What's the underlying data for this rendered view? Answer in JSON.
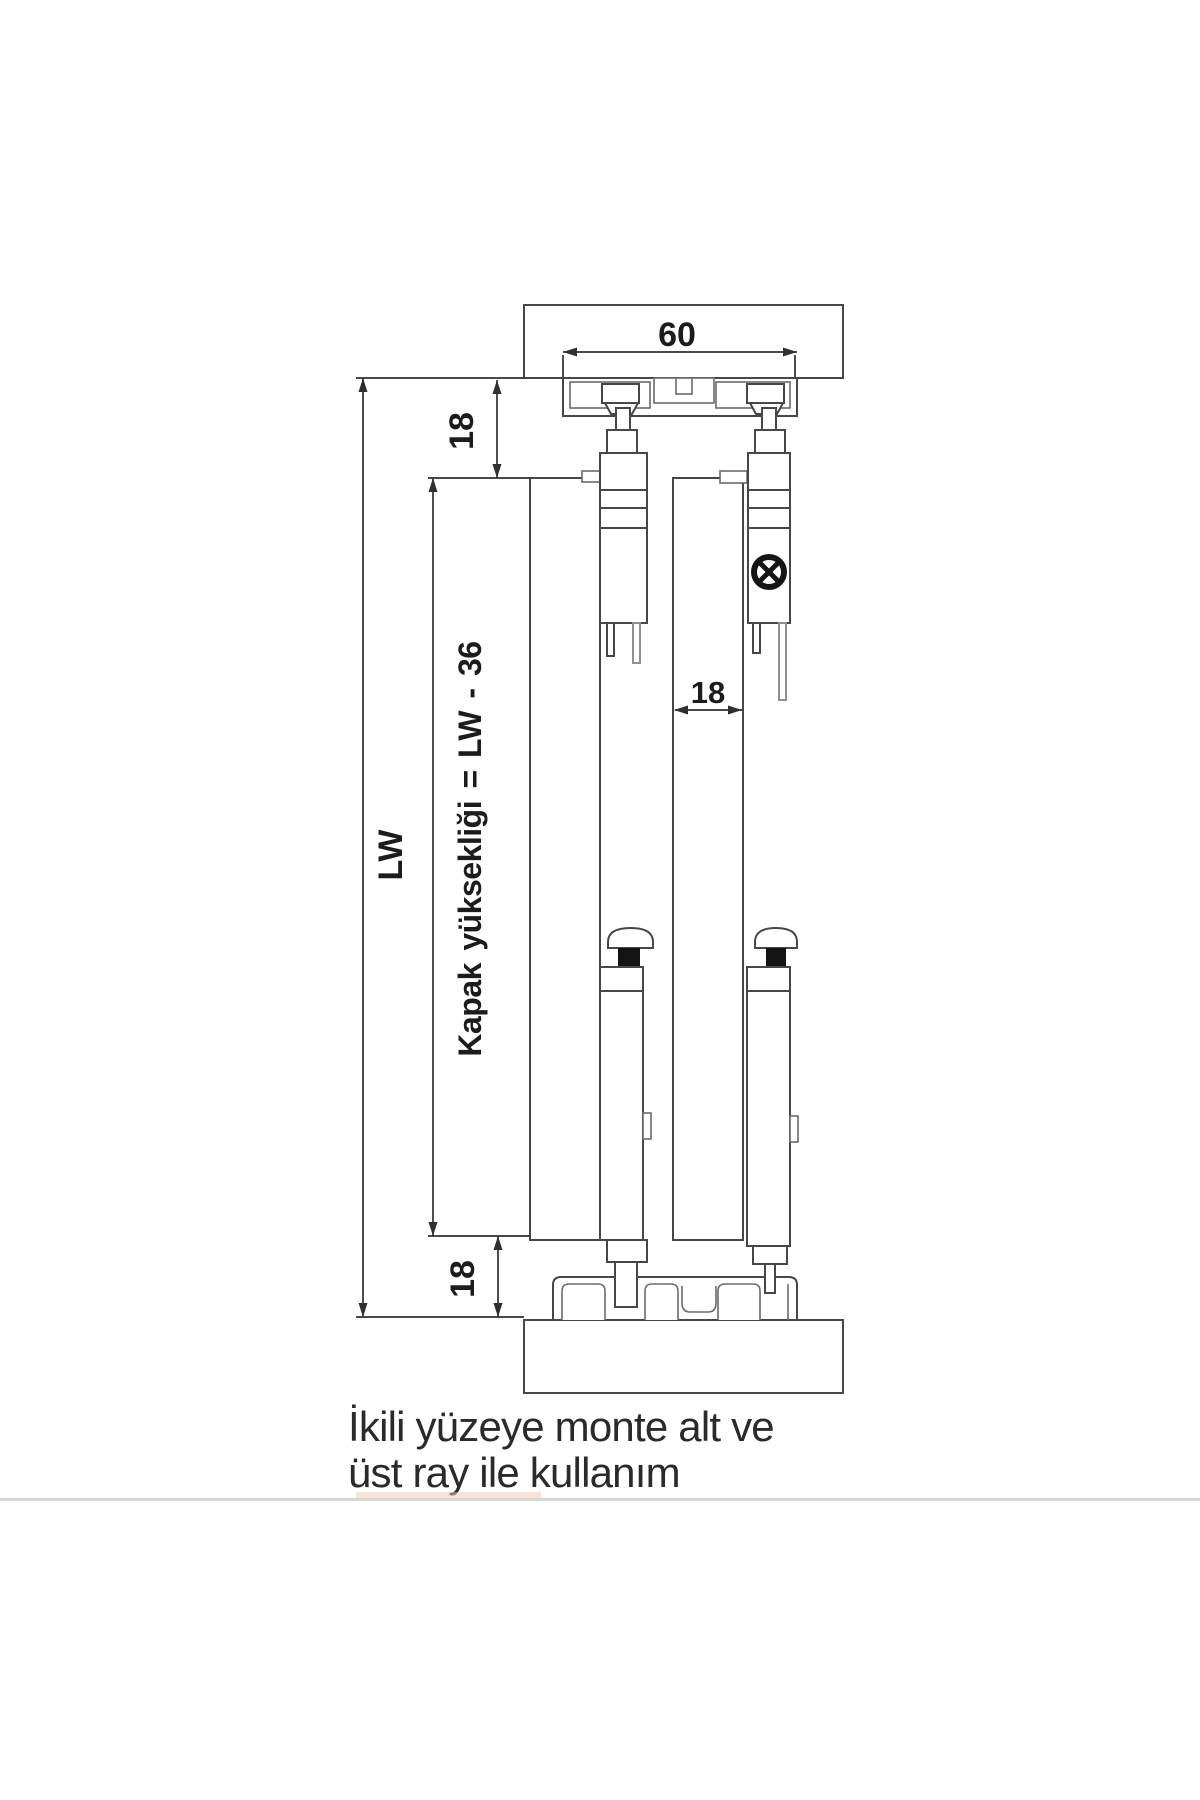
{
  "diagram": {
    "dims": {
      "rail_width": "60",
      "top_clearance": "18",
      "opening_height": "LW",
      "door_height_formula": "Kapak yüksekliği = LW - 36",
      "door_thickness": "18",
      "bottom_clearance": "18"
    },
    "caption_line1": "İkili yüzeye monte alt ve",
    "caption_line2": "üst ray ile kullanım",
    "colors": {
      "line": "#474747",
      "dimension": "#2f2f2f",
      "text": "#1c1c1c",
      "separator": "#d6d6d6",
      "highlight": "#f2c5ab",
      "guide_collar": "#141414",
      "background": "#ffffff"
    }
  }
}
